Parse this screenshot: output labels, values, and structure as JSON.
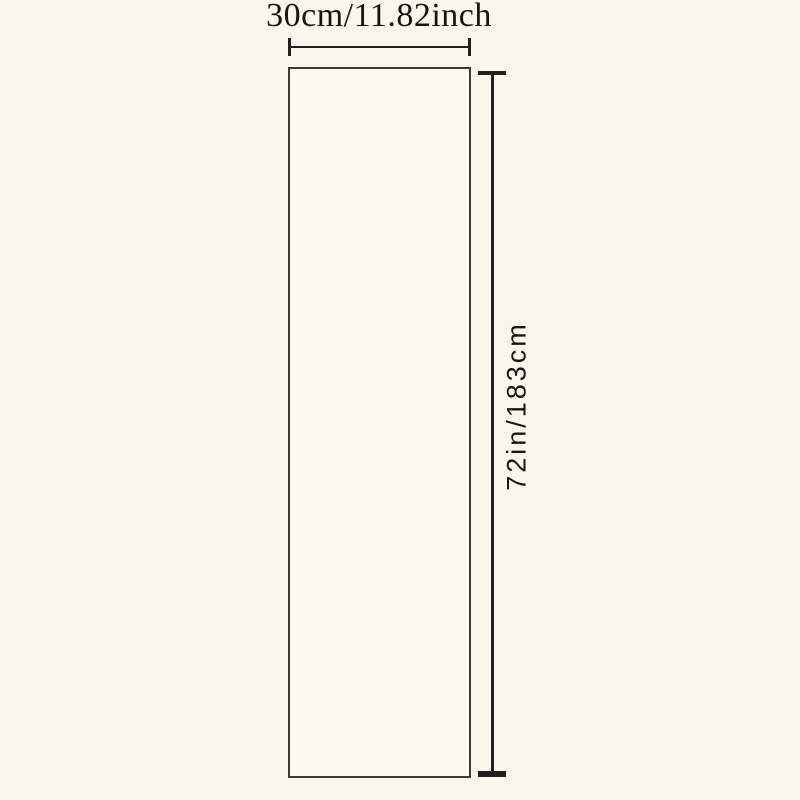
{
  "diagram": {
    "type": "product-dimension-diagram",
    "shape": "rectangle",
    "width_label": "30cm/11.82inch",
    "height_label": "72in/183cm"
  },
  "colors": {
    "bg": "#faf6eb",
    "line": "#211f1d",
    "border": "#3f3a35",
    "fill": "#fcf9f0",
    "text": "#171513"
  }
}
